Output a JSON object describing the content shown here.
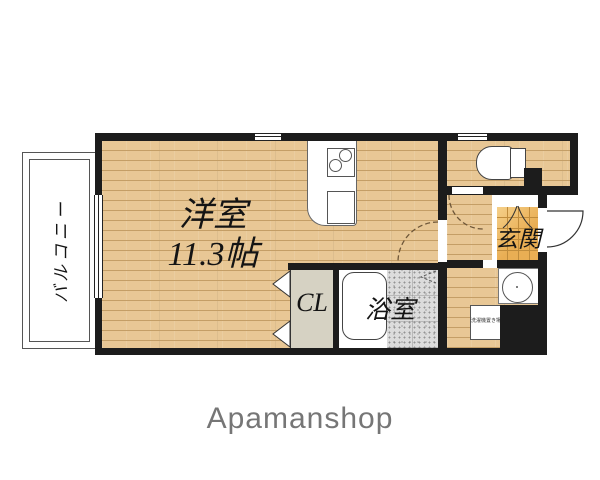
{
  "rooms": {
    "balcony": {
      "label": "バルコニー"
    },
    "main": {
      "label": "洋室",
      "size": "11.3帖"
    },
    "closet": {
      "label": "CL"
    },
    "bath": {
      "label": "浴室"
    },
    "entrance": {
      "label": "玄関"
    },
    "laundry": {
      "label": "洗濯機置き場"
    }
  },
  "footer": {
    "brand": "Apamanshop"
  },
  "colors": {
    "wall": "#1c1c1c",
    "floor": "#e8c795",
    "plank": "#c49e66",
    "closet-fill": "#d6d2c3",
    "bath-tile": "#dcdcdc",
    "genkan-tile": "#e9ae54",
    "genkan-grid": "#c08c3c",
    "logo": "#767676"
  }
}
